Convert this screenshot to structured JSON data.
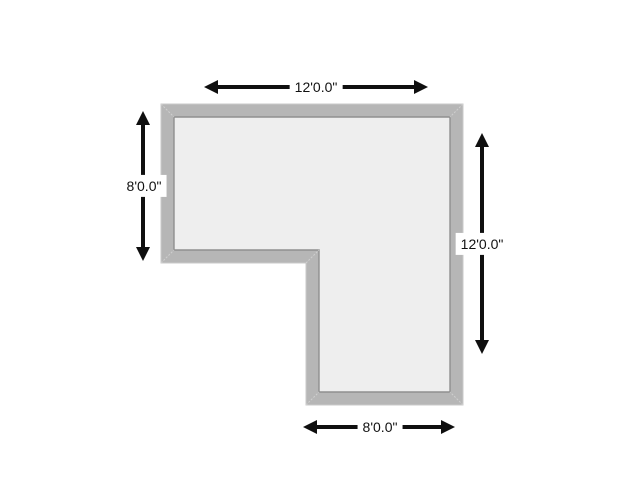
{
  "diagram": {
    "type": "floor-plan",
    "description": "L-shaped room outline with mitered gray walls and four dimension arrows",
    "dimensions": {
      "top": "12'0.0\"",
      "left": "8'0.0\"",
      "right": "12'0.0\"",
      "bottom": "8'0.0\""
    }
  },
  "colors": {
    "background": "#ffffff",
    "wall_fill": "#b6b6b6",
    "wall_outer_edge": "#c9c9c9",
    "wall_inner_edge": "#8f8f8f",
    "interior_fill": "#eeeeee",
    "miter_seam": "#cfcfcf",
    "arrow": "#0f0f0f",
    "label_text": "#111111",
    "label_background": "#ffffff"
  }
}
